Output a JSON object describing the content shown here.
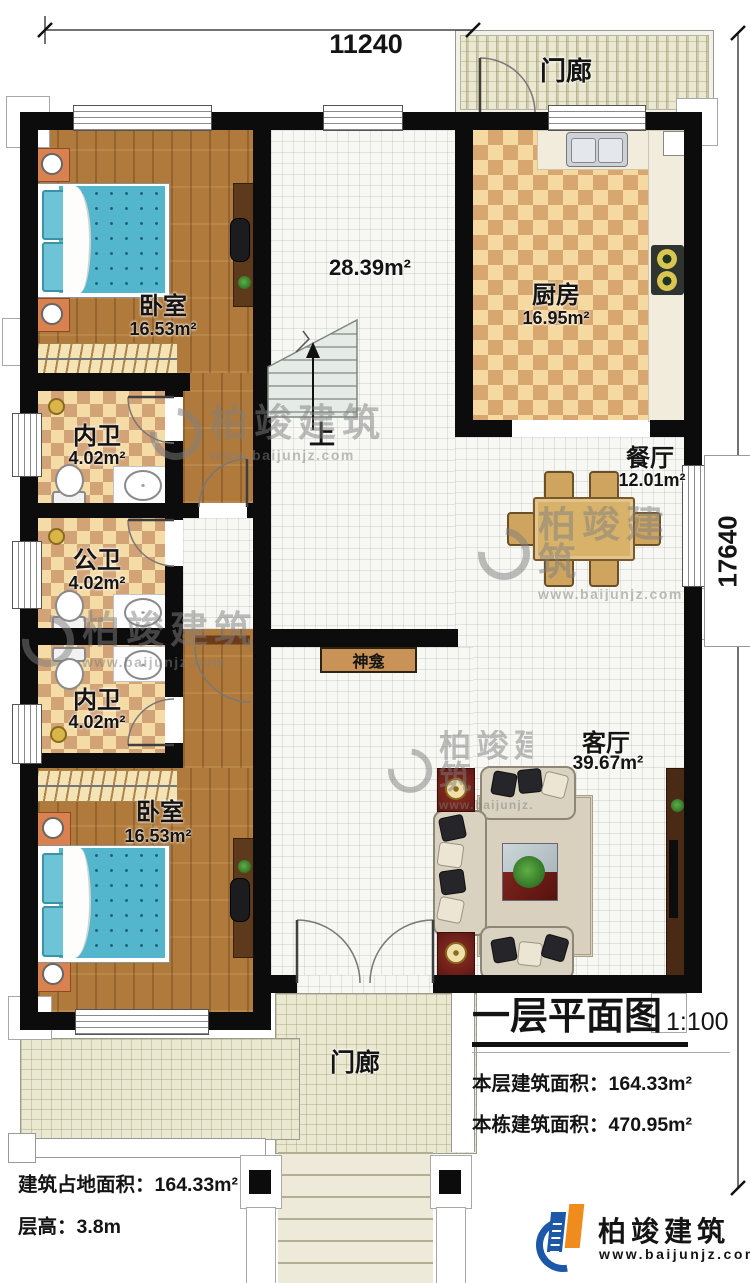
{
  "dimensions": {
    "width_mm": "11240",
    "depth_mm": "17640"
  },
  "rooms": {
    "porch_top": {
      "name": "门廊"
    },
    "kitchen": {
      "name": "厨房",
      "area": "16.95m²"
    },
    "dining": {
      "name": "餐厅",
      "area": "12.01m²"
    },
    "bedroom_top": {
      "name": "卧室",
      "area": "16.53m²"
    },
    "bath_top": {
      "name": "内卫",
      "area": "4.02m²"
    },
    "bath_middle": {
      "name": "公卫",
      "area": "4.02m²"
    },
    "bath_bottom": {
      "name": "内卫",
      "area": "4.02m²"
    },
    "bedroom_bottom": {
      "name": "卧室",
      "area": "16.53m²"
    },
    "living": {
      "name": "客厅",
      "area": "39.67m²"
    },
    "hall": {
      "area": "28.39m²"
    },
    "stairs": {
      "direction": "上"
    },
    "shrine": {
      "name": "神龛"
    },
    "porch_bottom": {
      "name": "门廊"
    }
  },
  "title_block": {
    "title": "一层平面图",
    "scale": "1:100",
    "floor_area_label": "本层建筑面积：",
    "floor_area_value": "164.33m²",
    "building_area_label": "本栋建筑面积：",
    "building_area_value": "470.95m²"
  },
  "site_info": {
    "footprint_label": "建筑占地面积：",
    "footprint_value": "164.33m²",
    "floor_height_label": "层高：",
    "floor_height_value": "3.8m"
  },
  "brand": {
    "name": "柏竣建筑",
    "website": "www.baijunjz.com"
  },
  "watermark": {
    "name": "柏竣建筑",
    "website": "www.baijunjz.com"
  },
  "colors": {
    "wall": "#0c0c0c",
    "wood_floor": "#b07a3c",
    "tile_light": "#f5dba6",
    "tile_dark": "#d2a377",
    "porch_tile": "#ebe8d1",
    "bed_blue": "#53b6cc",
    "logo_blue": "#1d57a8",
    "logo_orange": "#f08b1d"
  }
}
